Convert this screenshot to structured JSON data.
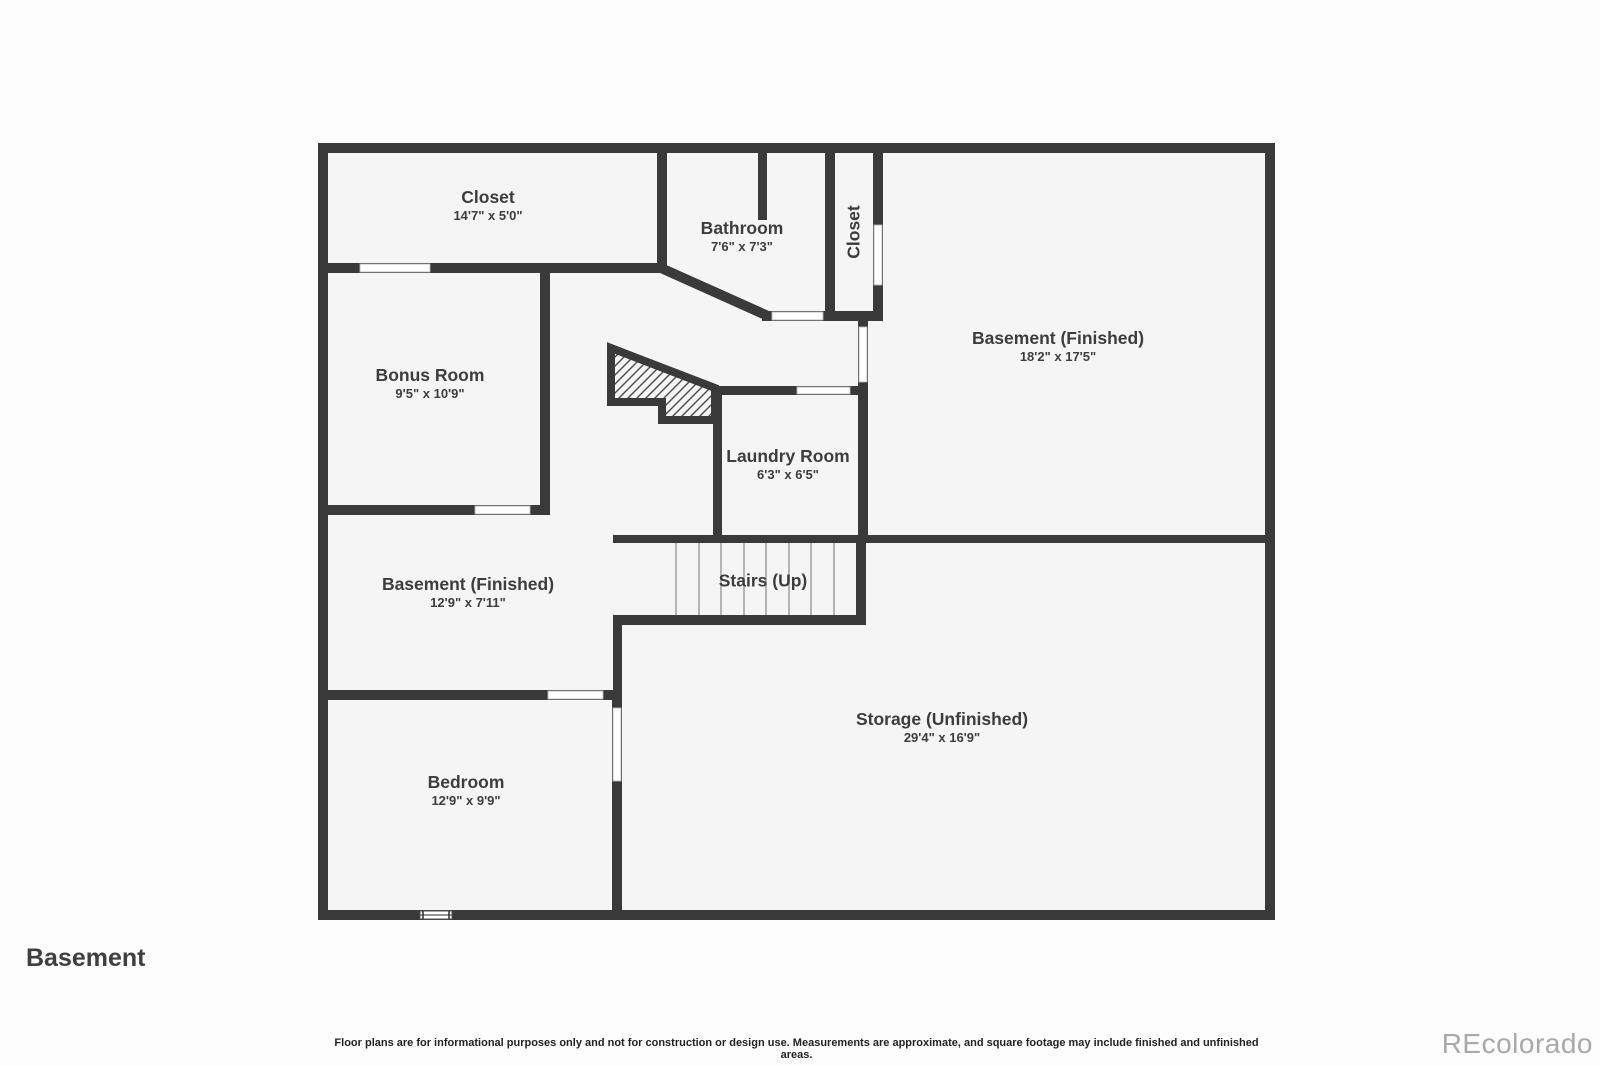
{
  "page": {
    "title": "Basement",
    "watermark": "REcolorado",
    "disclaimer": "Floor plans are for informational purposes only and not for construction or design use. Measurements are approximate, and square footage may include finished and unfinished areas."
  },
  "colors": {
    "wall": "#3a3a3a",
    "floor": "#f5f5f5",
    "background": "#fdfdfd",
    "label_text": "#3d3d3d",
    "opening_outline": "#b5b5b5",
    "tread_line": "#9e9e9e",
    "watermark_text": "#a9a9a9"
  },
  "rooms": {
    "closet_top": {
      "name": "Closet",
      "dims": "14'7\" x 5'0\""
    },
    "bathroom": {
      "name": "Bathroom",
      "dims": "7'6\" x 7'3\""
    },
    "closet_side": {
      "name": "Closet"
    },
    "basement_large": {
      "name": "Basement (Finished)",
      "dims": "18'2\" x 17'5\""
    },
    "bonus_room": {
      "name": "Bonus Room",
      "dims": "9'5\" x 10'9\""
    },
    "laundry": {
      "name": "Laundry Room",
      "dims": "6'3\" x 6'5\""
    },
    "basement_small": {
      "name": "Basement (Finished)",
      "dims": "12'9\" x 7'11\""
    },
    "stairs": {
      "name": "Stairs (Up)"
    },
    "storage": {
      "name": "Storage (Unfinished)",
      "dims": "29'4\" x 16'9\""
    },
    "bedroom": {
      "name": "Bedroom",
      "dims": "12'9\" x 9'9\""
    }
  }
}
